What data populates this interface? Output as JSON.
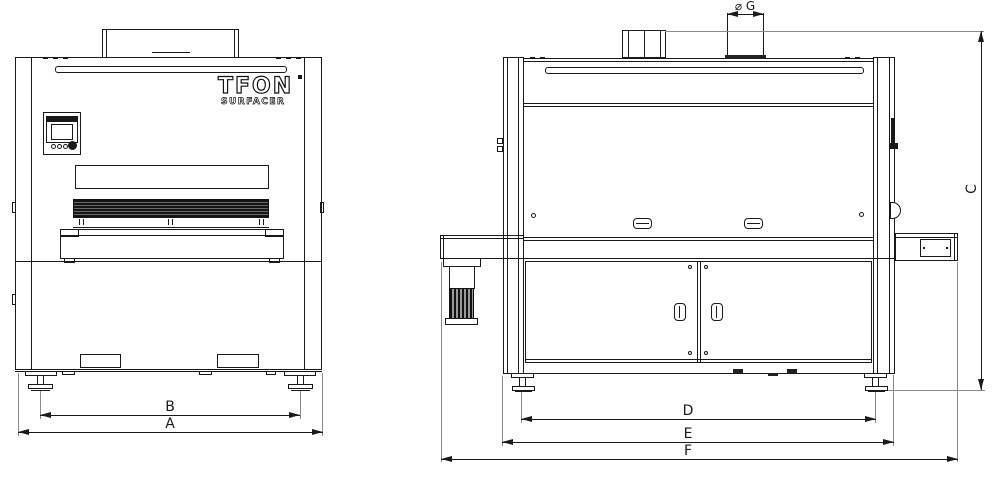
{
  "logo": {
    "brand": "TFON",
    "sub": "SURFACER"
  },
  "dims": {
    "a": "A",
    "b": "B",
    "c": "C",
    "d": "D",
    "e": "E",
    "f": "F",
    "g": "⌀ G"
  },
  "colors": {
    "line": "#1a1a1a",
    "ext": "#8a8a8a",
    "bg": "#ffffff",
    "dark": "#222222"
  }
}
